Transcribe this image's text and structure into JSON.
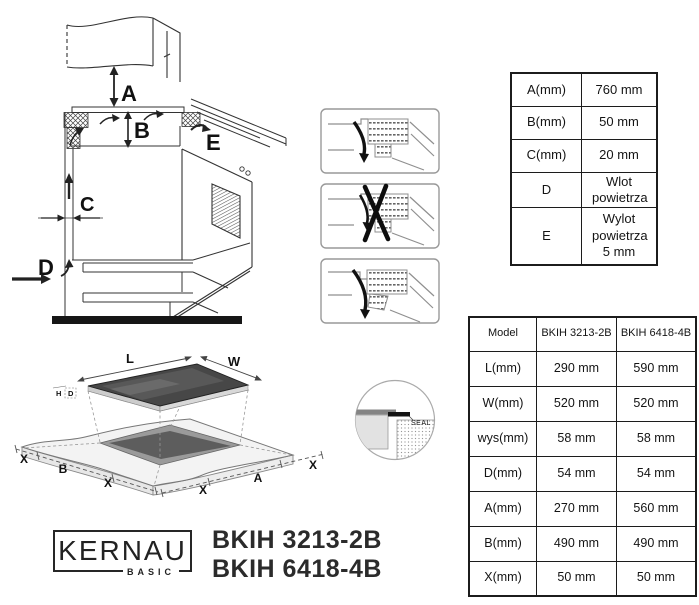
{
  "install_diagram": {
    "labels": {
      "A": "A",
      "B": "B",
      "C": "C",
      "D": "D",
      "E": "E"
    }
  },
  "cutout_diagram": {
    "labels": {
      "L": "L",
      "W": "W",
      "H": "H",
      "D": "D",
      "A": "A",
      "B": "B",
      "X": "X",
      "seal": "SEAL"
    }
  },
  "spec_table": {
    "rows": [
      {
        "label": "A(mm)",
        "value": "760 mm"
      },
      {
        "label": "B(mm)",
        "value": "50 mm"
      },
      {
        "label": "C(mm)",
        "value": "20 mm"
      },
      {
        "label": "D",
        "value": "Wlot powietrza"
      },
      {
        "label": "E",
        "value": "Wylot powietrza 5 mm"
      }
    ]
  },
  "model_table": {
    "headers": [
      "Model",
      "BKIH 3213-2B",
      "BKIH 6418-4B"
    ],
    "rows": [
      {
        "label": "L(mm)",
        "v1": "290 mm",
        "v2": "590 mm"
      },
      {
        "label": "W(mm)",
        "v1": "520 mm",
        "v2": "520 mm"
      },
      {
        "label": "wys(mm)",
        "v1": "58 mm",
        "v2": "58 mm"
      },
      {
        "label": "D(mm)",
        "v1": "54 mm",
        "v2": "54 mm"
      },
      {
        "label": "A(mm)",
        "v1": "270 mm",
        "v2": "560 mm"
      },
      {
        "label": "B(mm)",
        "v1": "490 mm",
        "v2": "490 mm"
      },
      {
        "label": "X(mm)",
        "v1": "50 mm",
        "v2": "50 mm"
      }
    ]
  },
  "branding": {
    "logo_text": "KERNAU",
    "logo_sub": "BASIC",
    "model_line1": "BKIH 3213-2B",
    "model_line2": "BKIH 6418-4B"
  }
}
